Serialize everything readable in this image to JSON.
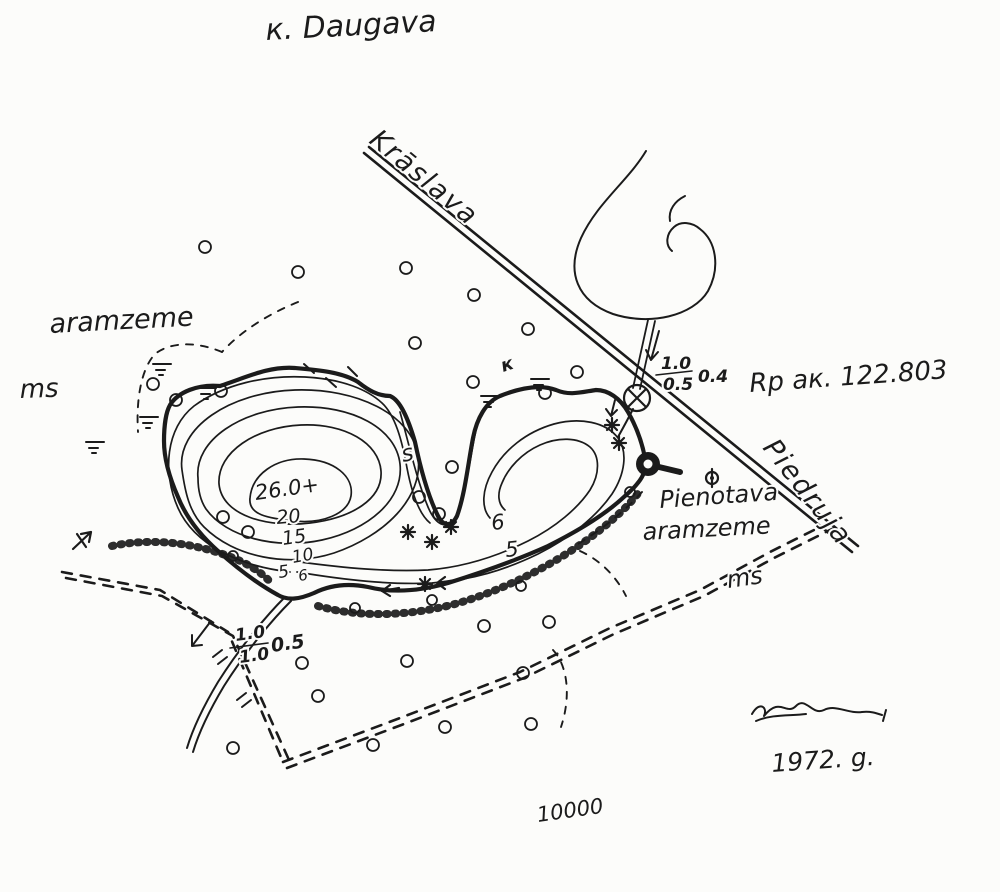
{
  "map": {
    "title": "к. Daugava",
    "scale": "10000",
    "year": "1972. g.",
    "road_labels": {
      "northwest": "Krāslava",
      "southeast": "Piedruja"
    },
    "benchmark": "Rp ак. 122.803",
    "culvert_note": {
      "numerator": "1.0",
      "denominator": "0.5",
      "extra": "0.4"
    },
    "outflow_note": {
      "numerator": "1.0",
      "denominator": "1.0",
      "extra": "0.5"
    },
    "land_labels": {
      "aramzeme_west": "aramzeme",
      "ms_west": "ms",
      "pienotava": "Pienotava",
      "aramzeme_east": "aramzeme",
      "ms_east": "ms"
    },
    "depths": {
      "max": "26.0+",
      "c20": "20",
      "c15": "15",
      "c10": "10",
      "c5_west": "5",
      "c6_west": "6",
      "c6_east": "6",
      "c5_east": "5"
    },
    "glyphs": {
      "s_mark": "s",
      "k_mark": "к"
    },
    "ink_color": "#1b1b1b",
    "paper_color": "#fcfcfa"
  }
}
